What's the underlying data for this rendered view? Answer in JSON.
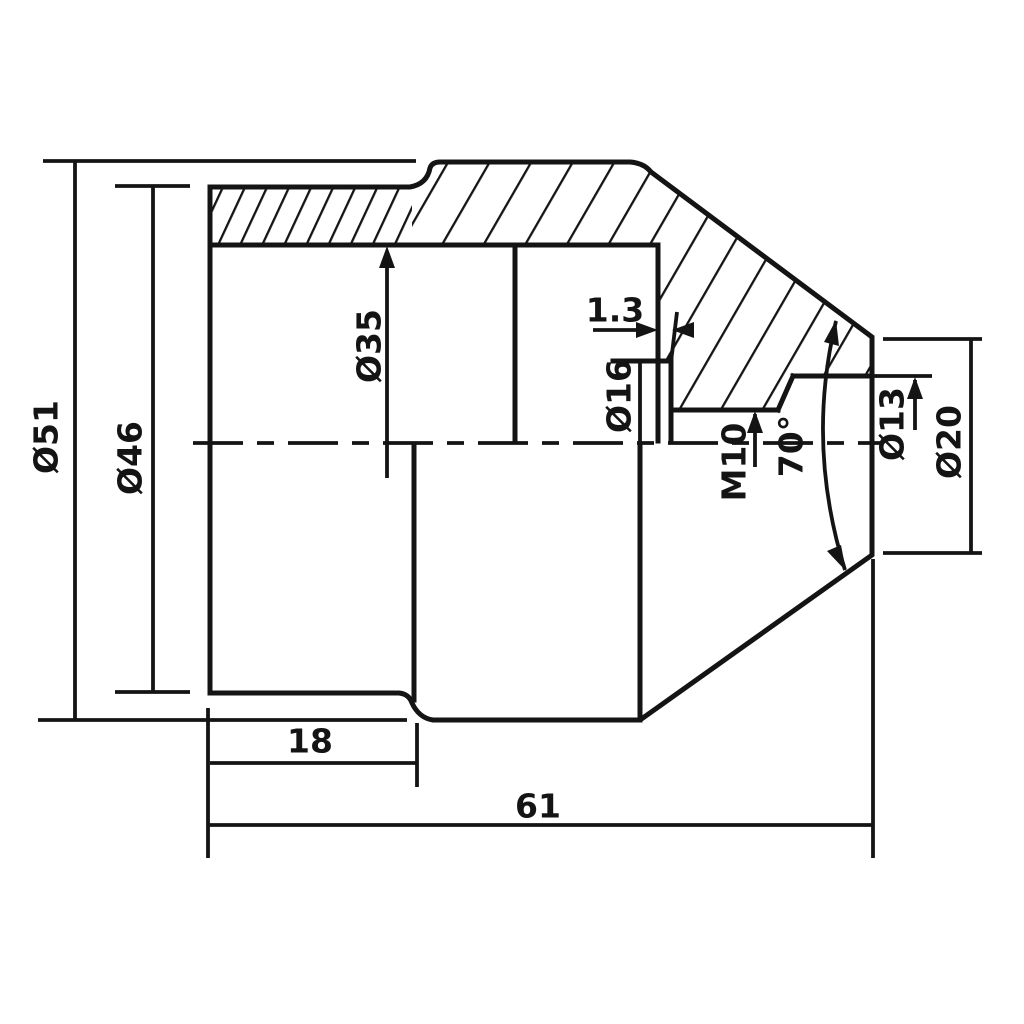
{
  "drawing": {
    "kind": "engineering-cross-section",
    "colors": {
      "line": "#141414",
      "background": "#ffffff"
    },
    "labels": {
      "dia51": "Ø51",
      "dia46": "Ø46",
      "dia35": "Ø35",
      "dia16": "Ø16",
      "m10": "M10",
      "angle70": "70°",
      "dia13": "Ø13",
      "dia20": "Ø20",
      "groove13": "1.3",
      "len18": "18",
      "len61": "61"
    },
    "dimensions": {
      "flange_diameter": 51,
      "left_cylinder_diameter": 46,
      "bore_diameter": 35,
      "relief_groove_diameter": 16,
      "relief_groove_width": 1.3,
      "thread": "M10",
      "tip_hole_diameter": 13,
      "tip_face_diameter": 20,
      "cone_angle_deg": 70,
      "left_cylinder_length": 18,
      "overall_length": 61
    }
  }
}
